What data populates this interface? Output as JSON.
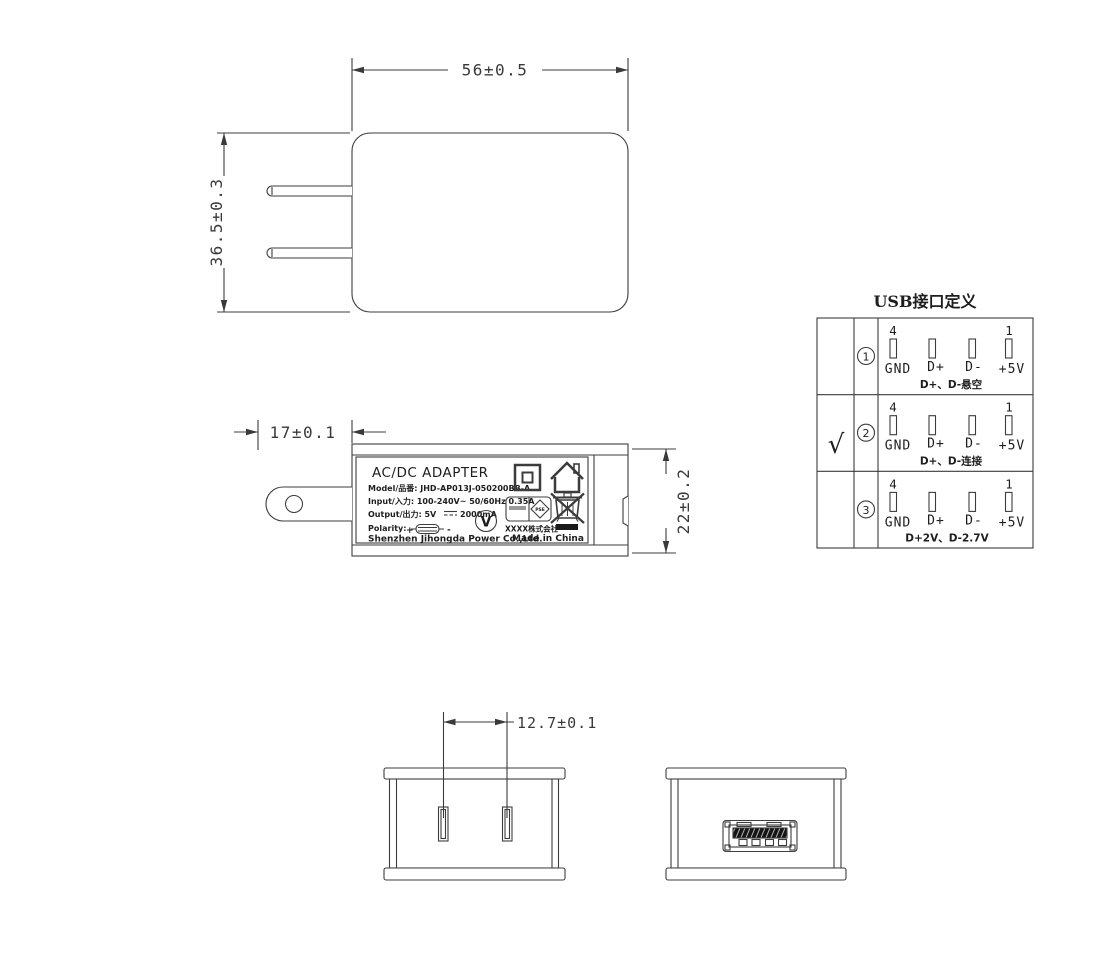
{
  "dims": {
    "width": "56±0.5",
    "height": "36.5±0.3",
    "prong_len": "17±0.1",
    "depth": "22±0.2",
    "pin_pitch": "12.7±0.1"
  },
  "label": {
    "title": "AC/DC  ADAPTER",
    "model": "Model/品番: JHD-AP013J-050200BB-A",
    "input": "Input/入力: 100-240V~  50/60Hz  0.35A",
    "output": "Output/出力: 5V",
    "output_ma": "2000mA",
    "polarity": "Polarity:",
    "plus": "+",
    "minus": "-",
    "company": "Shenzhen Jihongda Power Co.,Ltd.",
    "company_jp": "XXXX株式会社",
    "made_in": "Made in China",
    "efficiency": "V",
    "pse": "PSE"
  },
  "table": {
    "title": "USB接口定义",
    "pin4": "4",
    "pin1": "1",
    "pins": [
      "GND",
      "D+",
      "D-",
      "+5V"
    ],
    "check": "√",
    "rows": [
      {
        "num": "1",
        "note": "D+、D-悬空"
      },
      {
        "num": "2",
        "note": "D+、D-连接"
      },
      {
        "num": "3",
        "note": "D+2V、D-2.7V"
      }
    ]
  }
}
